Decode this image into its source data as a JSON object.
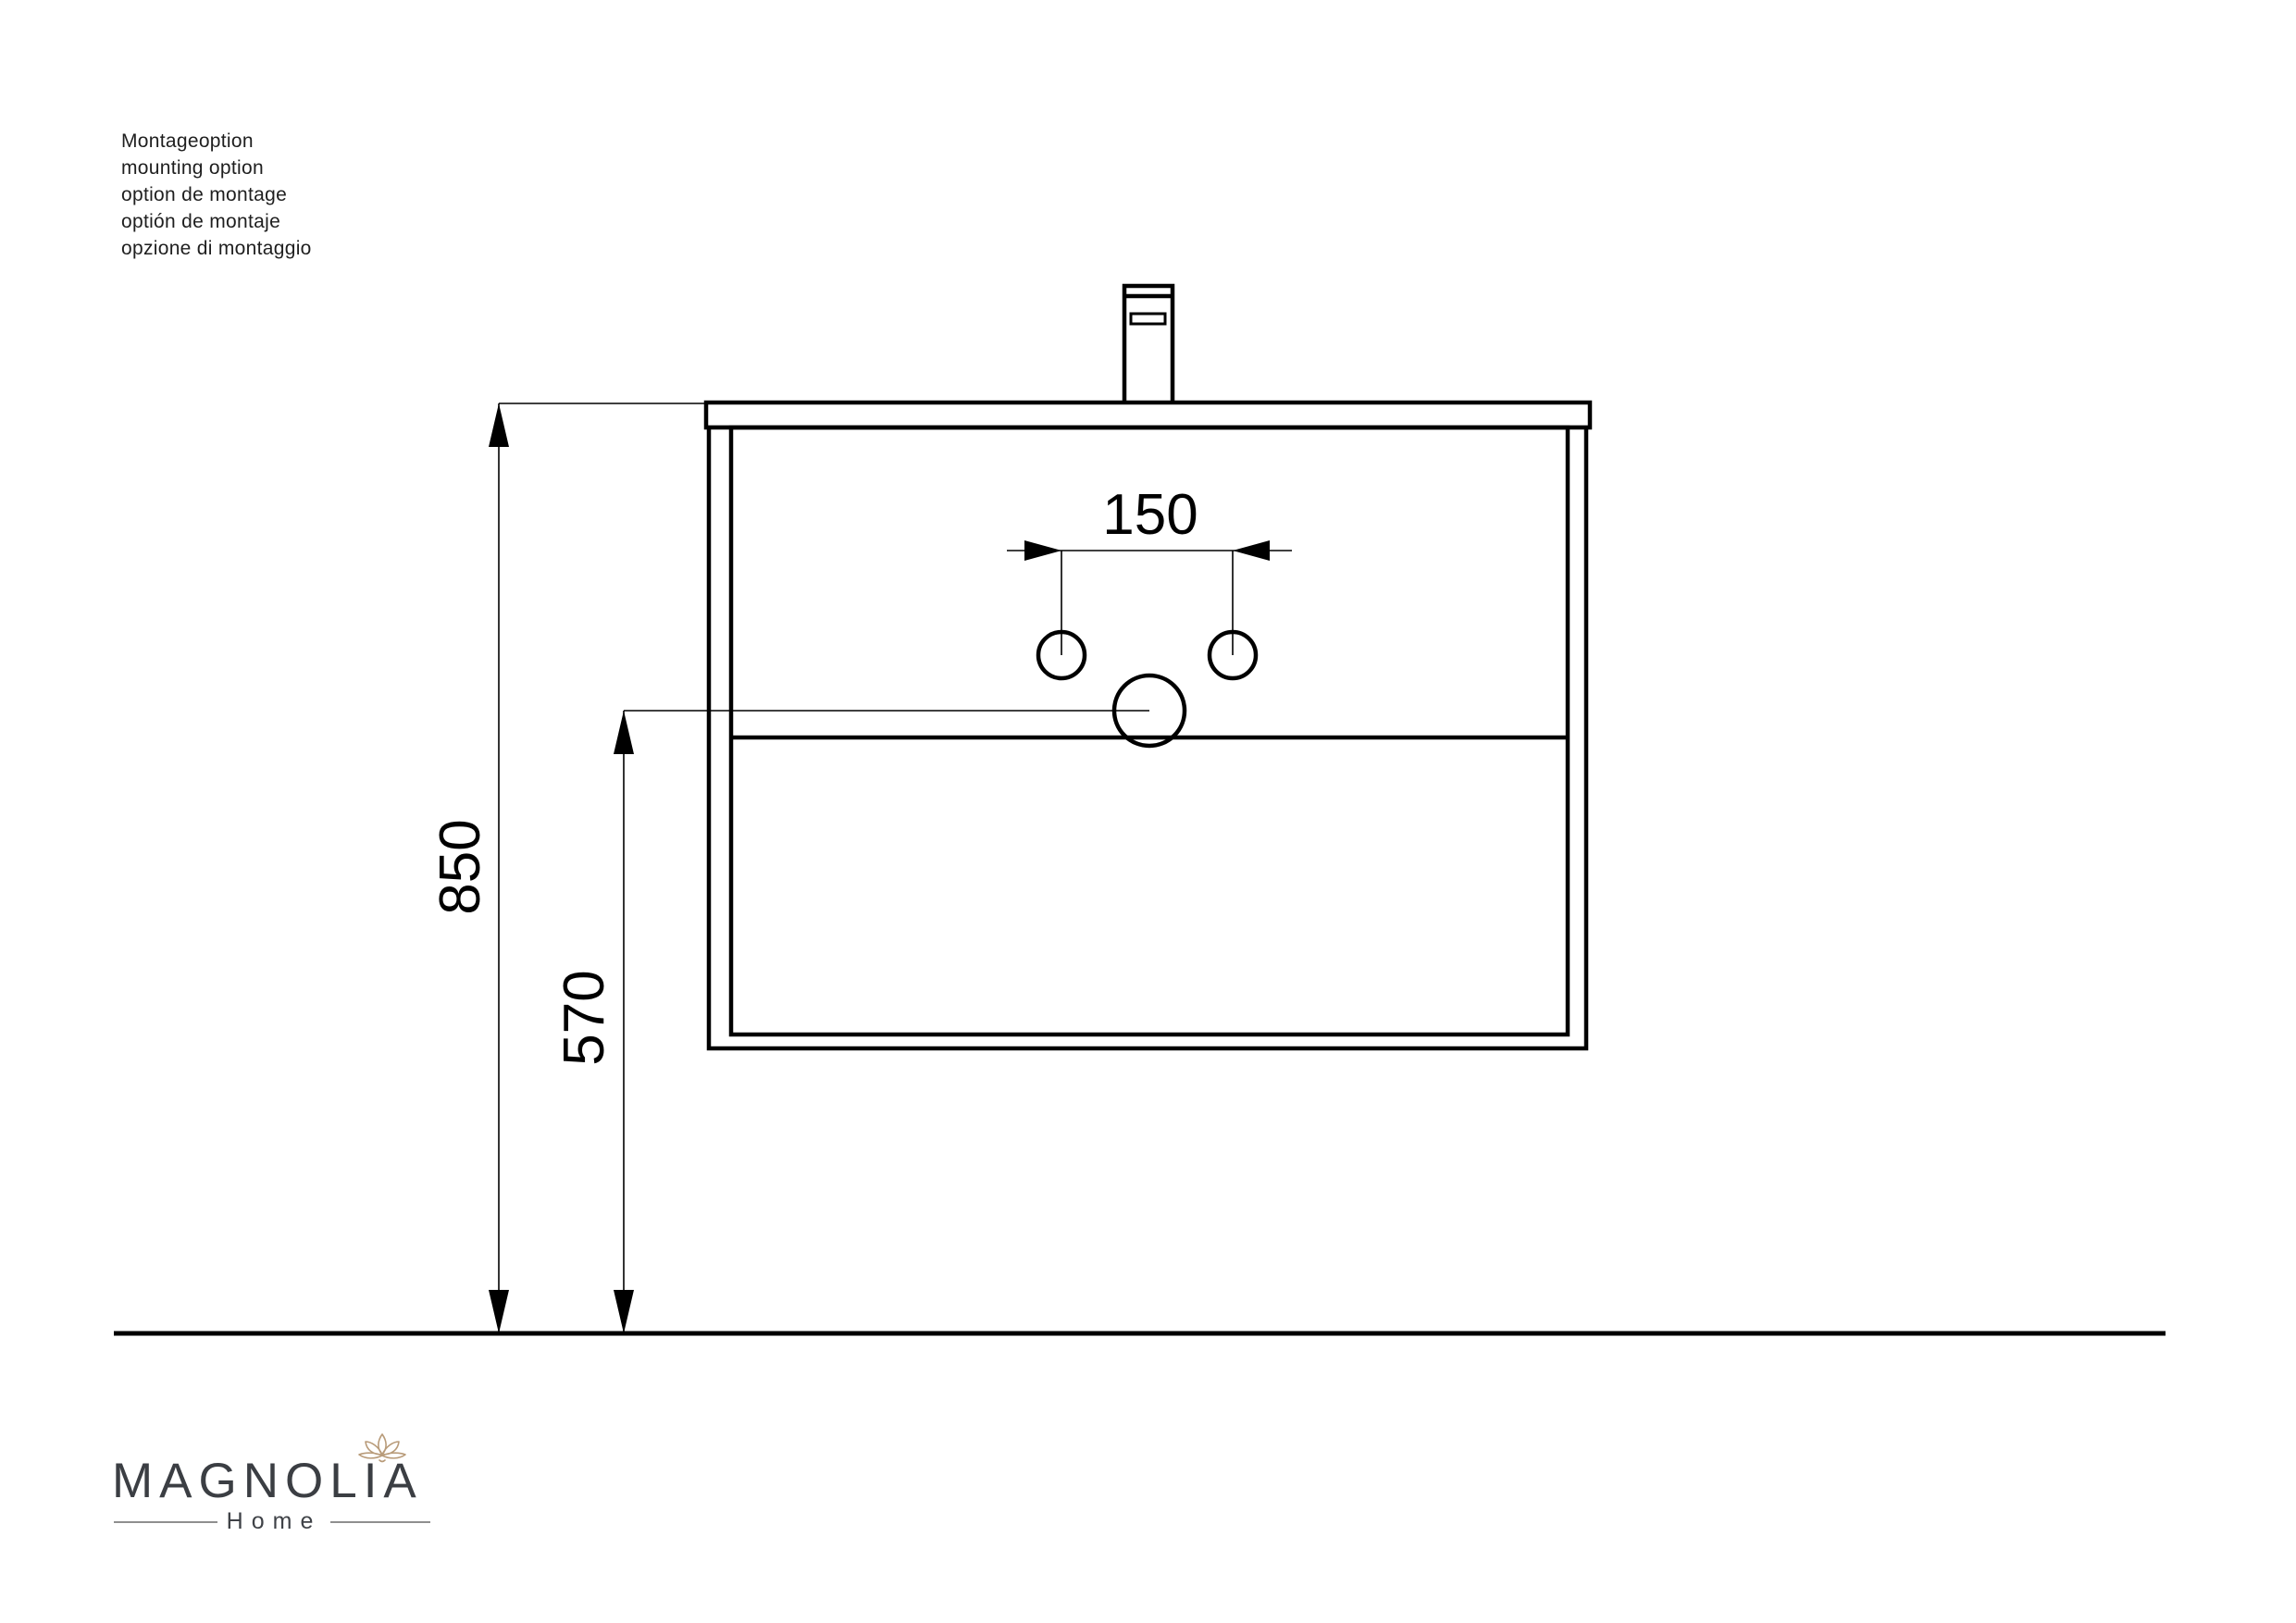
{
  "notes": {
    "lines": [
      "Montageoption",
      "mounting option",
      "option de montage",
      "optión de montaje",
      "opzione di montaggio"
    ]
  },
  "dimensions": {
    "hole_spacing_mm": "150",
    "mount_height_mm": "850",
    "bottom_edge_height_mm": "570"
  },
  "logo": {
    "brand": "MAGNOLIA",
    "subtitle": "Home"
  },
  "colors": {
    "drawing_line": "#000000",
    "logo_text": "#3b3e43",
    "flower_outline": "#b89b79",
    "subtitle_rule": "#8f8f8f"
  }
}
